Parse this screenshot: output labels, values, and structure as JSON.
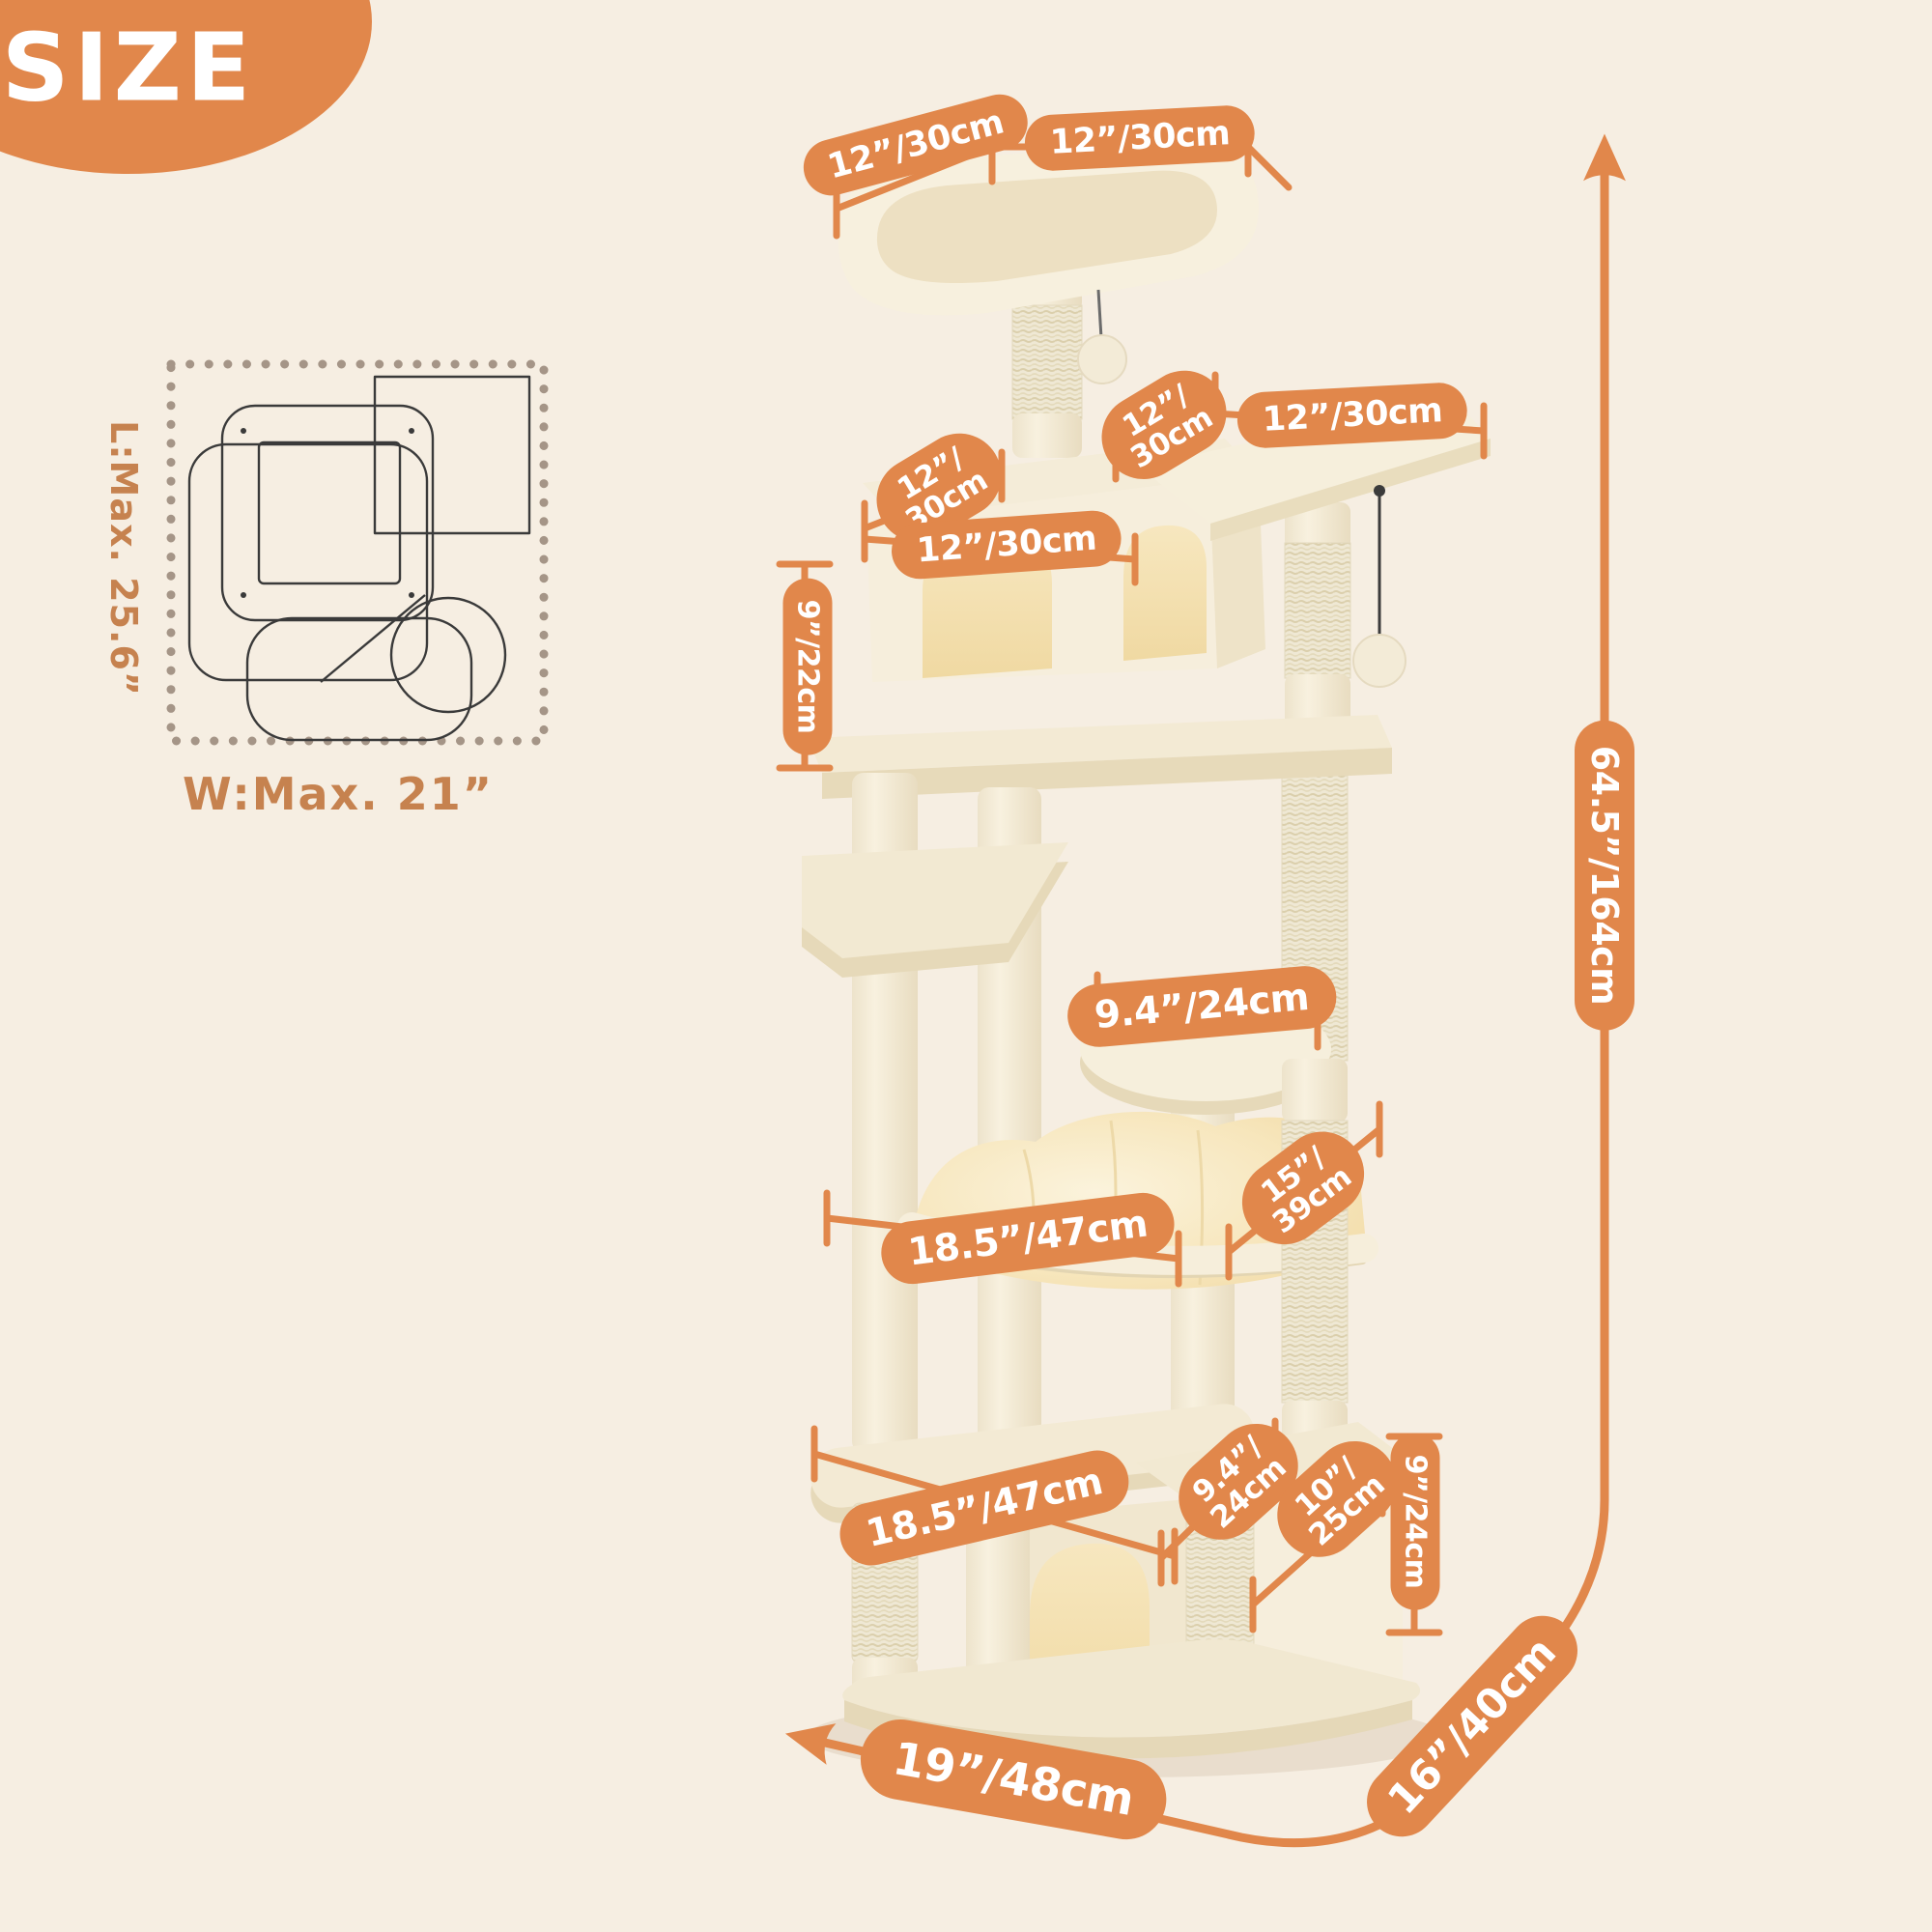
{
  "header": {
    "title": "SIZE"
  },
  "colors": {
    "background": "#F6EEE2",
    "accent": "#E1874B",
    "footprint_label": "#C6824F",
    "pill_text": "#FFFFFF"
  },
  "footprint": {
    "length_label": "L:Max. 25.6”",
    "width_label": "W:Max. 21”"
  },
  "measurements": {
    "perch_side": "12”/30cm",
    "perch_front": "12”/30cm",
    "upper_post_gap": {
      "line1": "12”/",
      "line2": "30cm"
    },
    "top_platform": "12”/30cm",
    "condo_side": {
      "line1": "12”/",
      "line2": "30cm"
    },
    "condo_front": "12”/30cm",
    "condo_height": "9”/22cm",
    "round_platform": "9.4”/24cm",
    "hammock_depth": {
      "line1": "15”/",
      "line2": "39cm"
    },
    "hammock_width": "18.5”/47cm",
    "lower_platform_width": "18.5”/47cm",
    "lower_condo_depth": {
      "line1": "9.4”/",
      "line2": "24cm"
    },
    "lower_condo_width": {
      "line1": "10”/",
      "line2": "25cm"
    },
    "lower_condo_height": "9”/24cm",
    "total_height": "64.5”/164cm",
    "base_length": "19”/48cm",
    "base_depth": "16”/40cm"
  }
}
